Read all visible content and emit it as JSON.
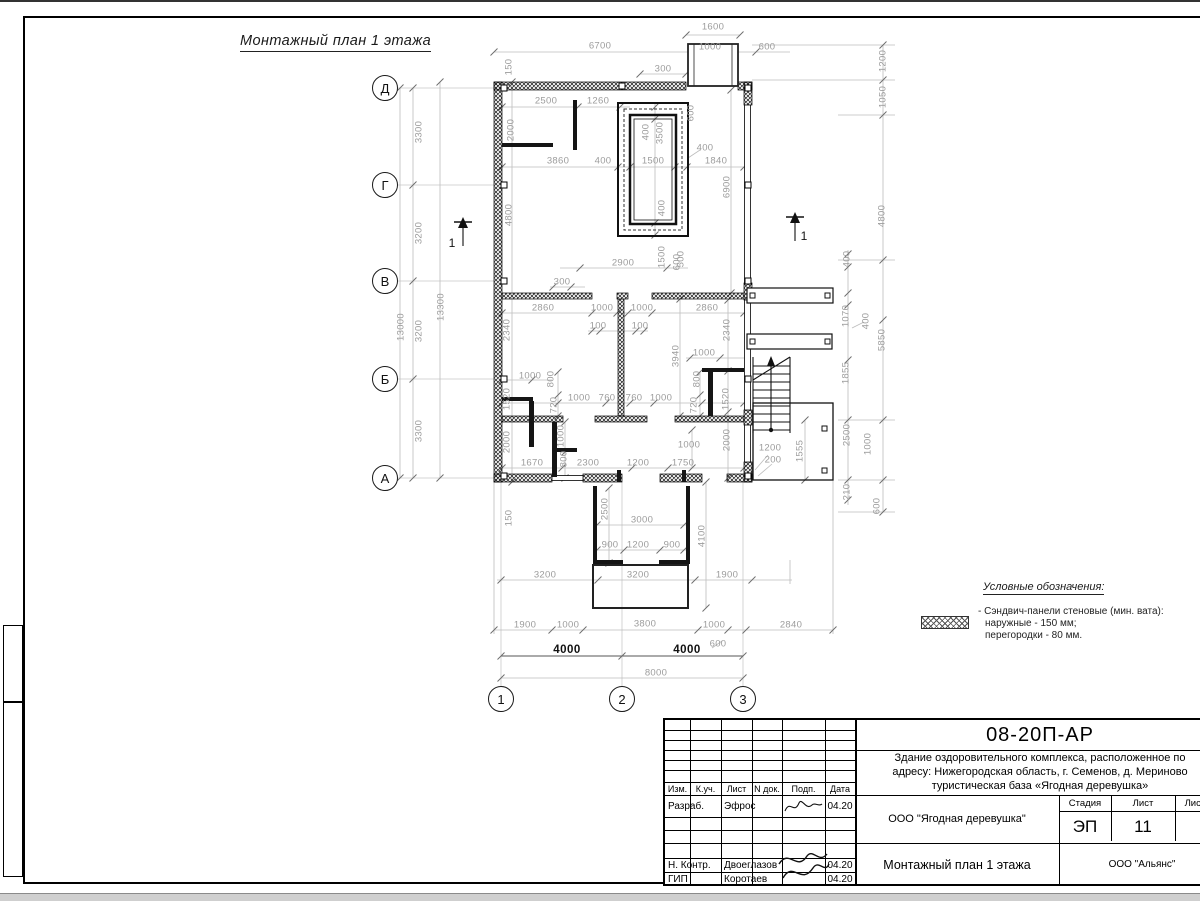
{
  "drawing": {
    "title": "Монтажный план 1 этажа",
    "legend": {
      "title": "Условные обозначения:",
      "item_line1": "- Сэндвич-панели стеновые (мин. вата):",
      "item_line2": "наружные - 150 мм;",
      "item_line3": "перегородки - 80 мм."
    },
    "axis_bubbles": [
      {
        "t": "Д",
        "x": 385,
        "y": 88
      },
      {
        "t": "Г",
        "x": 385,
        "y": 185
      },
      {
        "t": "В",
        "x": 385,
        "y": 281
      },
      {
        "t": "Б",
        "x": 385,
        "y": 379
      },
      {
        "t": "А",
        "x": 385,
        "y": 478
      },
      {
        "t": "1",
        "x": 501,
        "y": 699
      },
      {
        "t": "2",
        "x": 622,
        "y": 699
      },
      {
        "t": "3",
        "x": 743,
        "y": 699
      }
    ],
    "section_labels": [
      {
        "t": "1",
        "x": 452,
        "y": 243
      },
      {
        "t": "1",
        "x": 804,
        "y": 236
      }
    ],
    "dimensions": [
      {
        "t": "1600",
        "x": 713,
        "y": 27
      },
      {
        "t": "6700",
        "x": 600,
        "y": 46
      },
      {
        "t": "1000",
        "x": 710,
        "y": 47
      },
      {
        "t": "600",
        "x": 767,
        "y": 47
      },
      {
        "t": "300",
        "x": 663,
        "y": 69
      },
      {
        "t": "150",
        "x": 509,
        "y": 67,
        "r": 1
      },
      {
        "t": "2500",
        "x": 546,
        "y": 101
      },
      {
        "t": "1260",
        "x": 598,
        "y": 101
      },
      {
        "t": "2000",
        "x": 511,
        "y": 130,
        "r": 1
      },
      {
        "t": "600",
        "x": 691,
        "y": 113,
        "r": 1
      },
      {
        "t": "400",
        "x": 646,
        "y": 132,
        "r": 1
      },
      {
        "t": "3500",
        "x": 660,
        "y": 133,
        "r": 1
      },
      {
        "t": "3860",
        "x": 558,
        "y": 161
      },
      {
        "t": "400",
        "x": 603,
        "y": 161
      },
      {
        "t": "1500",
        "x": 653,
        "y": 161
      },
      {
        "t": "400",
        "x": 705,
        "y": 148
      },
      {
        "t": "1840",
        "x": 716,
        "y": 161
      },
      {
        "t": "6900",
        "x": 727,
        "y": 187,
        "r": 1
      },
      {
        "t": "4800",
        "x": 509,
        "y": 215,
        "r": 1
      },
      {
        "t": "400",
        "x": 662,
        "y": 208,
        "r": 1
      },
      {
        "t": "1500",
        "x": 662,
        "y": 257,
        "r": 1
      },
      {
        "t": "600",
        "x": 677,
        "y": 262,
        "r": 1
      },
      {
        "t": "2900",
        "x": 623,
        "y": 263
      },
      {
        "t": "500",
        "x": 681,
        "y": 259,
        "r": 1
      },
      {
        "t": "300",
        "x": 562,
        "y": 282
      },
      {
        "t": "2860",
        "x": 543,
        "y": 308
      },
      {
        "t": "1000",
        "x": 602,
        "y": 308
      },
      {
        "t": "1000",
        "x": 642,
        "y": 308
      },
      {
        "t": "2860",
        "x": 707,
        "y": 308
      },
      {
        "t": "100",
        "x": 598,
        "y": 326
      },
      {
        "t": "100",
        "x": 640,
        "y": 326
      },
      {
        "t": "2340",
        "x": 507,
        "y": 330,
        "r": 1
      },
      {
        "t": "2340",
        "x": 727,
        "y": 330,
        "r": 1
      },
      {
        "t": "3940",
        "x": 676,
        "y": 356,
        "r": 1
      },
      {
        "t": "1000",
        "x": 704,
        "y": 353
      },
      {
        "t": "1000",
        "x": 530,
        "y": 376
      },
      {
        "t": "1520",
        "x": 507,
        "y": 399,
        "r": 1
      },
      {
        "t": "800",
        "x": 551,
        "y": 379,
        "r": 1
      },
      {
        "t": "720",
        "x": 554,
        "y": 405,
        "r": 1
      },
      {
        "t": "1000",
        "x": 579,
        "y": 398
      },
      {
        "t": "760",
        "x": 607,
        "y": 398
      },
      {
        "t": "760",
        "x": 634,
        "y": 398
      },
      {
        "t": "1000",
        "x": 661,
        "y": 398
      },
      {
        "t": "800",
        "x": 697,
        "y": 379,
        "r": 1
      },
      {
        "t": "720",
        "x": 694,
        "y": 405,
        "r": 1
      },
      {
        "t": "1520",
        "x": 726,
        "y": 399,
        "r": 1
      },
      {
        "t": "2000",
        "x": 507,
        "y": 442,
        "r": 1
      },
      {
        "t": "1000",
        "x": 561,
        "y": 436,
        "r": 1
      },
      {
        "t": "800",
        "x": 564,
        "y": 459,
        "r": 1
      },
      {
        "t": "1670",
        "x": 532,
        "y": 463
      },
      {
        "t": "2300",
        "x": 588,
        "y": 463
      },
      {
        "t": "1200",
        "x": 638,
        "y": 463
      },
      {
        "t": "1750",
        "x": 683,
        "y": 463
      },
      {
        "t": "1000",
        "x": 689,
        "y": 445
      },
      {
        "t": "2000",
        "x": 727,
        "y": 440,
        "r": 1
      },
      {
        "t": "1200",
        "x": 770,
        "y": 448
      },
      {
        "t": "200",
        "x": 773,
        "y": 460
      },
      {
        "t": "1555",
        "x": 800,
        "y": 451,
        "r": 1
      },
      {
        "t": "400",
        "x": 847,
        "y": 259,
        "r": 1
      },
      {
        "t": "1070",
        "x": 846,
        "y": 316,
        "r": 1
      },
      {
        "t": "400",
        "x": 866,
        "y": 321,
        "r": 1
      },
      {
        "t": "1855",
        "x": 846,
        "y": 373,
        "r": 1
      },
      {
        "t": "2500",
        "x": 847,
        "y": 435,
        "r": 1
      },
      {
        "t": "210",
        "x": 847,
        "y": 492,
        "r": 1
      },
      {
        "t": "1200",
        "x": 883,
        "y": 61,
        "r": 1
      },
      {
        "t": "1050",
        "x": 883,
        "y": 97,
        "r": 1
      },
      {
        "t": "4800",
        "x": 882,
        "y": 216,
        "r": 1
      },
      {
        "t": "5850",
        "x": 882,
        "y": 340,
        "r": 1
      },
      {
        "t": "1000",
        "x": 868,
        "y": 444,
        "r": 1
      },
      {
        "t": "600",
        "x": 877,
        "y": 506,
        "r": 1
      },
      {
        "t": "150",
        "x": 509,
        "y": 518,
        "r": 1
      },
      {
        "t": "2500",
        "x": 605,
        "y": 509,
        "r": 1
      },
      {
        "t": "3000",
        "x": 642,
        "y": 520
      },
      {
        "t": "900",
        "x": 610,
        "y": 545
      },
      {
        "t": "1200",
        "x": 638,
        "y": 545
      },
      {
        "t": "900",
        "x": 672,
        "y": 545
      },
      {
        "t": "4100",
        "x": 702,
        "y": 536,
        "r": 1
      },
      {
        "t": "3200",
        "x": 545,
        "y": 575
      },
      {
        "t": "3200",
        "x": 638,
        "y": 575
      },
      {
        "t": "1900",
        "x": 727,
        "y": 575
      },
      {
        "t": "1900",
        "x": 525,
        "y": 625
      },
      {
        "t": "1000",
        "x": 568,
        "y": 625
      },
      {
        "t": "3800",
        "x": 645,
        "y": 624
      },
      {
        "t": "1000",
        "x": 714,
        "y": 625
      },
      {
        "t": "2840",
        "x": 791,
        "y": 625
      },
      {
        "t": "600",
        "x": 718,
        "y": 644
      },
      {
        "t": "4000",
        "x": 567,
        "y": 650,
        "d": 1
      },
      {
        "t": "4000",
        "x": 687,
        "y": 650,
        "d": 1
      },
      {
        "t": "8000",
        "x": 656,
        "y": 673
      },
      {
        "t": "3300",
        "x": 419,
        "y": 132,
        "r": 1
      },
      {
        "t": "3200",
        "x": 419,
        "y": 233,
        "r": 1
      },
      {
        "t": "3200",
        "x": 419,
        "y": 331,
        "r": 1
      },
      {
        "t": "3300",
        "x": 419,
        "y": 431,
        "r": 1
      },
      {
        "t": "13000",
        "x": 401,
        "y": 327,
        "r": 1
      },
      {
        "t": "13300",
        "x": 441,
        "y": 307,
        "r": 1
      }
    ]
  },
  "title_block": {
    "code": "08-20П-АР",
    "project_line1": "Здание оздоровительного комплекса, расположенное по",
    "project_line2": "адресу: Нижегородская область, г. Семенов, д. Мериново",
    "project_line3": "туристическая база «Ягодная деревушка»",
    "org": "ООО \"Ягодная деревушка\"",
    "company": "ООО \"Альянс\"",
    "drawing_title": "Монтажный план 1 этажа",
    "stage_label": "Стадия",
    "sheet_label": "Лист",
    "sheets_label": "Листов",
    "stage": "ЭП",
    "sheet": "11",
    "columns": [
      "Изм.",
      "К.уч.",
      "Лист",
      "N док.",
      "Подп.",
      "Дата"
    ],
    "rows": [
      {
        "role": "Разраб.",
        "name": "Эфрос",
        "date": "04.20"
      },
      {
        "role": "",
        "name": "",
        "date": ""
      },
      {
        "role": "",
        "name": "",
        "date": ""
      },
      {
        "role": "",
        "name": "",
        "date": ""
      },
      {
        "role": "Н. Контр.",
        "name": "Двоеглазов",
        "date": "04.20"
      },
      {
        "role": "ГИП",
        "name": "Коротаев",
        "date": "04.20"
      }
    ]
  }
}
